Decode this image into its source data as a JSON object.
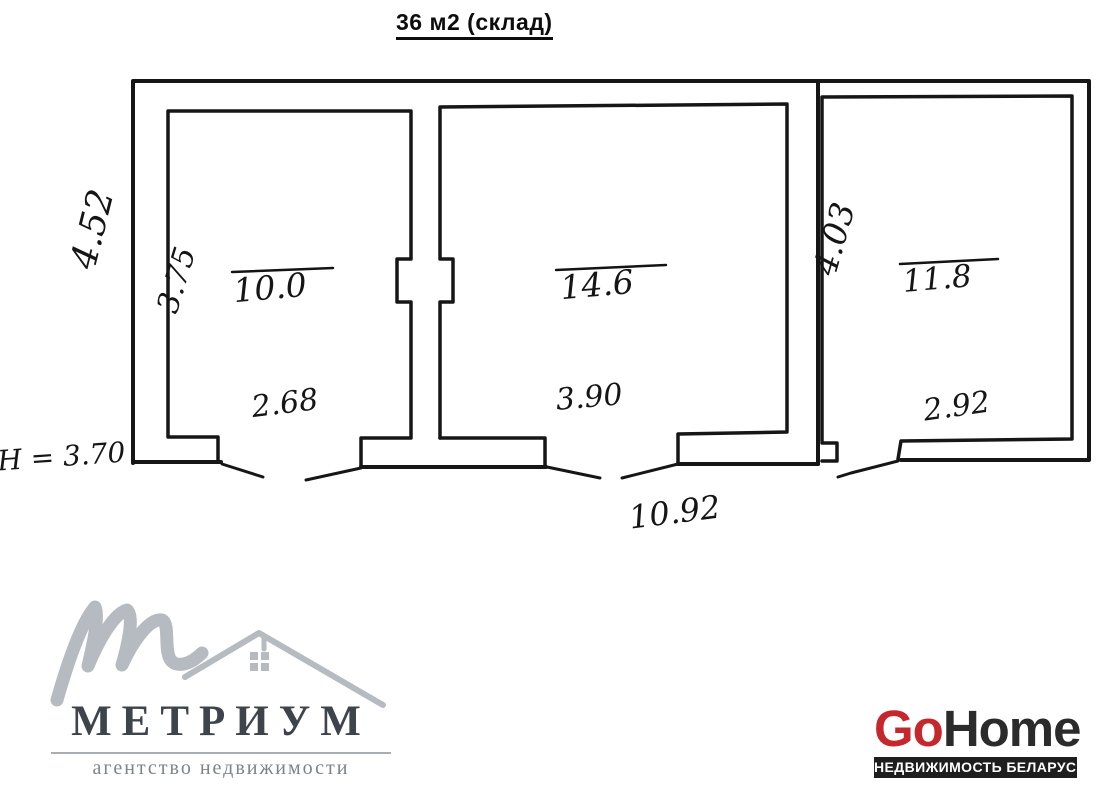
{
  "title": "36 м2 (склад)",
  "plan": {
    "height_note": "Н = 3.70",
    "overall": {
      "side_height": "4.52",
      "bottom_width": "10.92"
    },
    "rooms": [
      {
        "id": "left",
        "area": "10.0",
        "depth": "3.75",
        "width": "2.68"
      },
      {
        "id": "middle",
        "area": "14.6",
        "width": "3.90"
      },
      {
        "id": "right",
        "area": "11.8",
        "depth": "4.03",
        "width": "2.92"
      }
    ]
  },
  "branding": {
    "metrium": {
      "name": "МЕТРИУМ",
      "tagline": "агентство недвижимости"
    },
    "gohome": {
      "go": "Go",
      "home": "Home",
      "tagline": "НЕДВИЖИМОСТЬ БЕЛАРУСИ"
    }
  },
  "colors": {
    "ink": "#151515",
    "metrium_gray": "#b6bbc1",
    "metrium_text": "#3e444b",
    "gohome_red": "#c5272c",
    "gohome_dark": "#2b2b2b"
  }
}
